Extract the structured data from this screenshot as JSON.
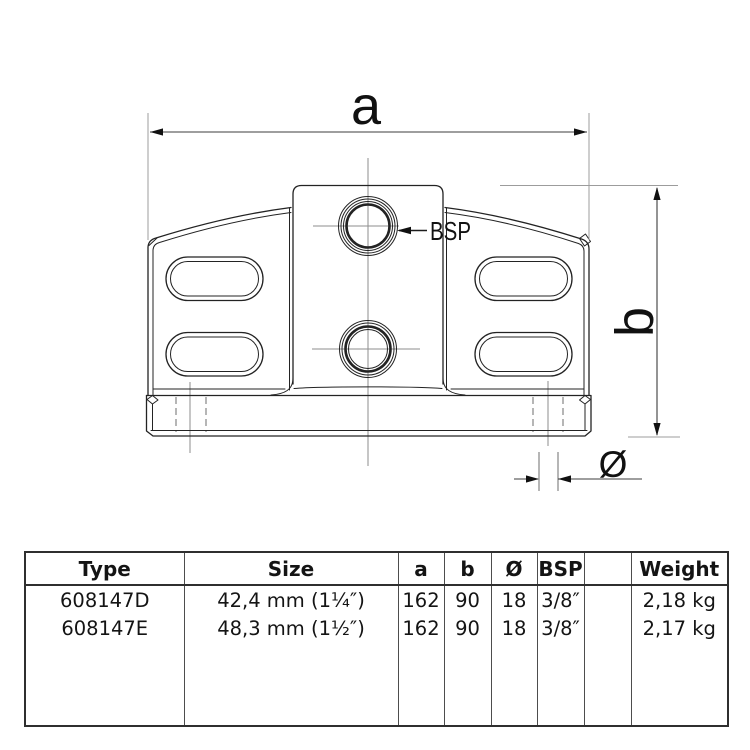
{
  "drawing": {
    "dim_labels": {
      "a": "a",
      "b": "b",
      "diameter": "Ø",
      "bsp": "BSP"
    }
  },
  "table": {
    "headers": {
      "type": "Type",
      "size": "Size",
      "a": "a",
      "b": "b",
      "diameter": "Ø",
      "bsp": "BSP",
      "spare": "",
      "weight": "Weight"
    },
    "rows": [
      {
        "type": "608147D",
        "size": "42,4 mm (1¼″)",
        "a": "162",
        "b": "90",
        "diameter": "18",
        "bsp": "3/8″",
        "spare": "",
        "weight": "2,18 kg"
      },
      {
        "type": "608147E",
        "size": "48,3 mm (1½″)",
        "a": "162",
        "b": "90",
        "diameter": "18",
        "bsp": "3/8″",
        "spare": "",
        "weight": "2,17 kg"
      }
    ]
  }
}
